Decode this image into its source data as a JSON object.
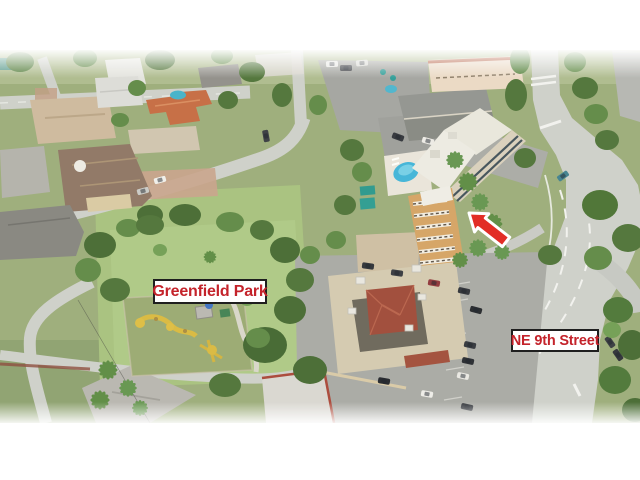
{
  "canvas": {
    "width": 640,
    "height": 480,
    "background": "#ffffff"
  },
  "photo": {
    "type": "aerial-drone-photograph",
    "description": "Aerial view of a coastal residential neighborhood: single-family homes upper left, Greenfield Park with playground in center, a mid-rise condo building with pool marked by a red arrow, a commercial building with parking lot at bottom, and NE 9th Street curving along the right side",
    "haze_color": "#ffffff"
  },
  "annotations": {
    "style": {
      "label_background": "#ffffff",
      "label_border_color": "#1f1f1f",
      "label_text_color": "#c4232b"
    },
    "park_label": {
      "text": "Greenfield Park"
    },
    "street_label": {
      "text": "NE 9th Street"
    },
    "arrow": {
      "points_to": "condo-building",
      "direction": "up-left",
      "fill": "#e22d26",
      "outline": "#ffffff"
    }
  },
  "scene": {
    "park_lawn_color": "#a6c07b",
    "playground_surface_color": "#98a86e",
    "playground_equipment_color": "#d9b83a",
    "tree_color": "#4c7134",
    "palm_color": "#5a8a3f",
    "road_color": "#cdcfc8",
    "parking_lot_color": "#a7a8a2",
    "pool_color": "#3eb3d6",
    "condo_wall_color": "#d4a260",
    "condo_roof_color": "#eceadf",
    "commercial_roof_color": "#d3c9ad",
    "red_hip_roof_color": "#9e4734",
    "orange_tile_roof_color": "#c4693e",
    "mansion_roof_color": "#8d7360"
  }
}
